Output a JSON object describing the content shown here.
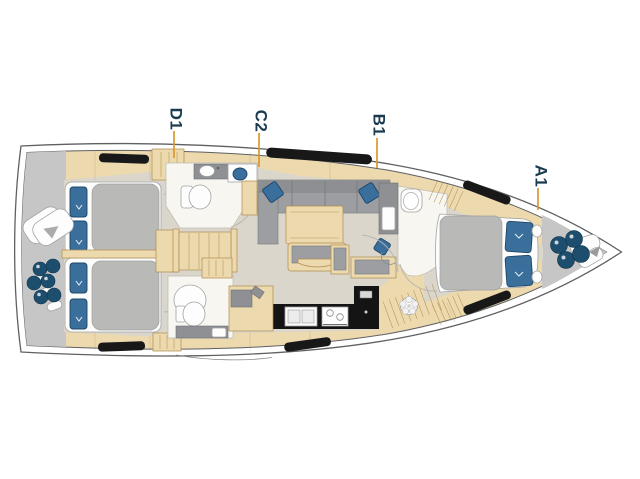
{
  "diagram": {
    "type": "yacht-interior-floor-plan",
    "orientation": "bow-right-stern-left",
    "cabin_labels": [
      {
        "id": "D1",
        "text": "D1"
      },
      {
        "id": "C2",
        "text": "C2"
      },
      {
        "id": "B1",
        "text": "B1"
      },
      {
        "id": "A1",
        "text": "A1"
      }
    ]
  },
  "colors": {
    "hull_line": "#5f6063",
    "deck_gray": "#c6c6c7",
    "floor": "#dad6cb",
    "wood": "#ecd9ae",
    "wood_stroke": "#b08c4f",
    "room_white": "#f8f6f0",
    "vanity_gray": "#8e9094",
    "sofa_gray": "#9c9ea1",
    "duvet_gray": "#b9bab8",
    "pillow_blue": "#3a6f9c",
    "pillow_edge": "#1c4668",
    "fender_navy": "#1d4e6e",
    "label_navy": "#1b3c50",
    "leader_orange": "#d9992e"
  }
}
